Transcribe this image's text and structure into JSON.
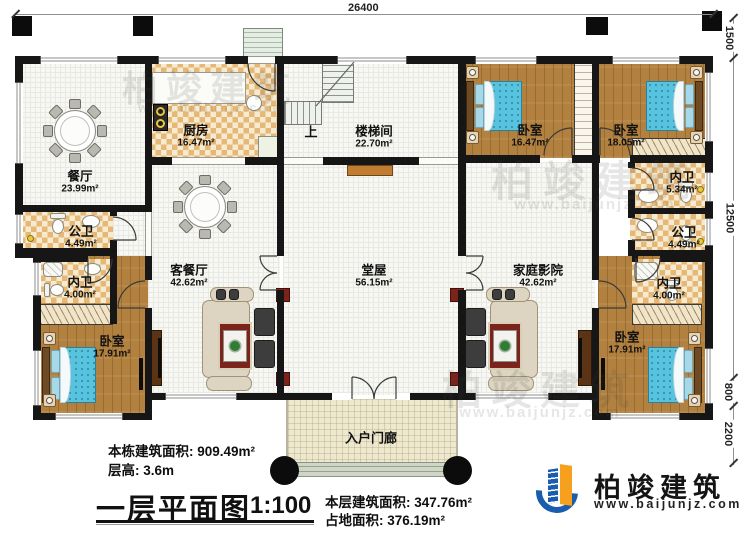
{
  "title": {
    "main": "一层平面图",
    "scale": "1:100"
  },
  "dimensions": {
    "top": "26400",
    "right_eave": "1500",
    "right_main": "12500",
    "right_step": "800",
    "right_porch": "2200"
  },
  "rooms": {
    "dining": {
      "name": "餐厅",
      "area": "23.99m²"
    },
    "kitchen": {
      "name": "厨房",
      "area": "16.47m²"
    },
    "stairwell": {
      "name": "楼梯间",
      "area": "22.70m²"
    },
    "stairs_up": "上",
    "hall": {
      "name": "堂屋",
      "area": "56.15m²"
    },
    "living": {
      "name": "客餐厅",
      "area": "42.62m²"
    },
    "theater": {
      "name": "家庭影院",
      "area": "42.62m²"
    },
    "bedroom_top_left": {
      "name": "卧室",
      "area": "16.47m²"
    },
    "bedroom_top_right": {
      "name": "卧室",
      "area": "18.05m²"
    },
    "bedroom_bottom_left": {
      "name": "卧室",
      "area": "17.91m²"
    },
    "bedroom_bottom_right": {
      "name": "卧室",
      "area": "17.91m²"
    },
    "bath_public_left": {
      "name": "公卫",
      "area": "4.49m²"
    },
    "bath_ensuite_left": {
      "name": "内卫",
      "area": "4.00m²"
    },
    "bath_ensuite_top_right": {
      "name": "内卫",
      "area": "5.34m²"
    },
    "bath_public_right": {
      "name": "公卫",
      "area": "4.49m²"
    },
    "bath_ensuite_bottom_right": {
      "name": "内卫",
      "area": "4.00m²"
    },
    "porch": {
      "name": "入户门廊"
    }
  },
  "stats": {
    "building_total": "本栋建筑面积: 909.49m²",
    "floor_height": "层高: 3.6m",
    "floor_area": "本层建筑面积: 347.76m²",
    "footprint": "占地面积: 376.19m²"
  },
  "logo": {
    "name": "柏竣建筑",
    "website": "www.baijunjz.com"
  },
  "watermark": {
    "text": "柏竣建筑",
    "website": "www.baijunjz.com"
  },
  "colors": {
    "wall": "#161616",
    "wood_floor": "#b2813f",
    "checker": "#e6b877",
    "tile": "#f7f7f3",
    "bed": "#57c3de",
    "logo_blue": "#1a5cad",
    "logo_orange": "#f6a01d",
    "rug_red": "#7c241c"
  }
}
